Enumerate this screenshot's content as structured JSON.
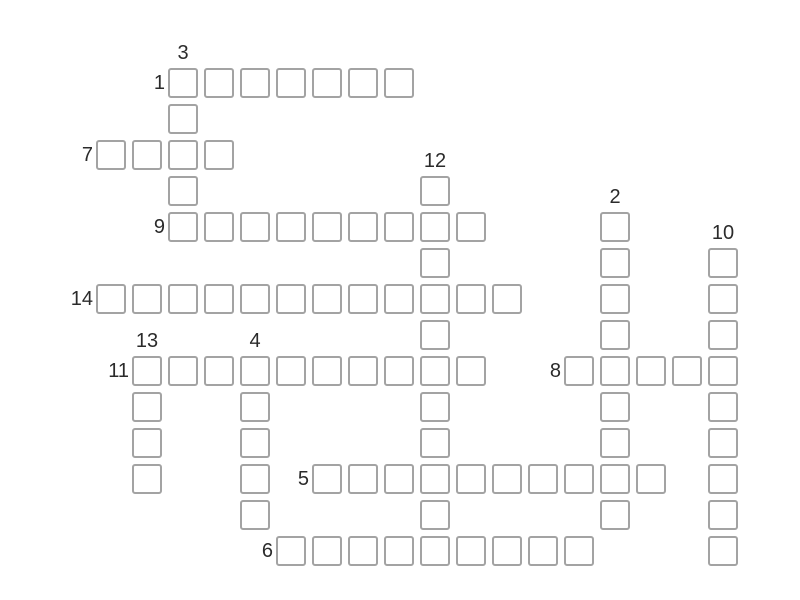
{
  "canvas": {
    "width": 800,
    "height": 600,
    "background": "#ffffff"
  },
  "puzzle": {
    "type": "crossword-grid",
    "state": "empty",
    "word_count": 14
  },
  "grid": {
    "origin_x": 96,
    "origin_y": 68,
    "pitch": 36,
    "cell_size": 30,
    "columns": 18,
    "rows": 14,
    "cell_border_color": "#a3a3a3",
    "cell_fill_color": "#ffffff",
    "number_color": "#2b2b2b",
    "across_label_gap": 3,
    "down_label_gap": 26
  },
  "words": [
    {
      "number": "1",
      "direction": "across",
      "col": 2,
      "row": 0,
      "length": 7
    },
    {
      "number": "2",
      "direction": "down",
      "col": 14,
      "row": 4,
      "length": 9
    },
    {
      "number": "3",
      "direction": "down",
      "col": 2,
      "row": 0,
      "length": 5
    },
    {
      "number": "4",
      "direction": "down",
      "col": 4,
      "row": 8,
      "length": 5
    },
    {
      "number": "5",
      "direction": "across",
      "col": 6,
      "row": 11,
      "length": 10
    },
    {
      "number": "6",
      "direction": "across",
      "col": 5,
      "row": 13,
      "length": 9
    },
    {
      "number": "7",
      "direction": "across",
      "col": 0,
      "row": 2,
      "length": 4
    },
    {
      "number": "8",
      "direction": "across",
      "col": 13,
      "row": 8,
      "length": 5
    },
    {
      "number": "9",
      "direction": "across",
      "col": 2,
      "row": 4,
      "length": 9
    },
    {
      "number": "10",
      "direction": "down",
      "col": 17,
      "row": 5,
      "length": 9
    },
    {
      "number": "11",
      "direction": "across",
      "col": 1,
      "row": 8,
      "length": 10
    },
    {
      "number": "12",
      "direction": "down",
      "col": 9,
      "row": 3,
      "length": 11
    },
    {
      "number": "13",
      "direction": "down",
      "col": 1,
      "row": 8,
      "length": 4
    },
    {
      "number": "14",
      "direction": "across",
      "col": 0,
      "row": 6,
      "length": 12
    }
  ]
}
